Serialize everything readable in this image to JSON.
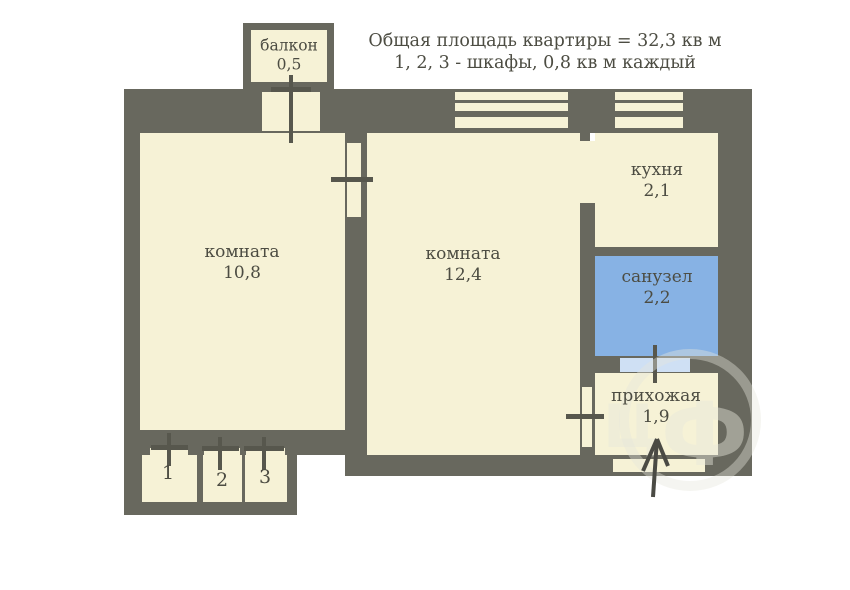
{
  "header": {
    "line1": "Общая площадь квартиры = 32,3 кв м",
    "line2": "1, 2, 3 - шкафы, 0,8 кв м каждый"
  },
  "rooms": {
    "balcony": {
      "name": "балкон",
      "area": "0,5"
    },
    "room1": {
      "name": "комната",
      "area": "10,8"
    },
    "room2": {
      "name": "комната",
      "area": "12,4"
    },
    "kitchen": {
      "name": "кухня",
      "area": "2,1"
    },
    "bathroom": {
      "name": "санузел",
      "area": "2,2"
    },
    "hallway": {
      "name": "прихожая",
      "area": "1,9"
    }
  },
  "closets": {
    "labels": [
      "1",
      "2",
      "3"
    ]
  },
  "watermark": {
    "letter1": "Ц",
    "letter2": "Ф"
  },
  "colors": {
    "wall": "#68685e",
    "room_fill": "#f6f2d6",
    "bathroom_fill": "#87b2e4",
    "bathroom_door_opening": "#cfe0f4",
    "text": "#4c4c42",
    "background": "#ffffff",
    "watermark": "#e6e6dc"
  }
}
